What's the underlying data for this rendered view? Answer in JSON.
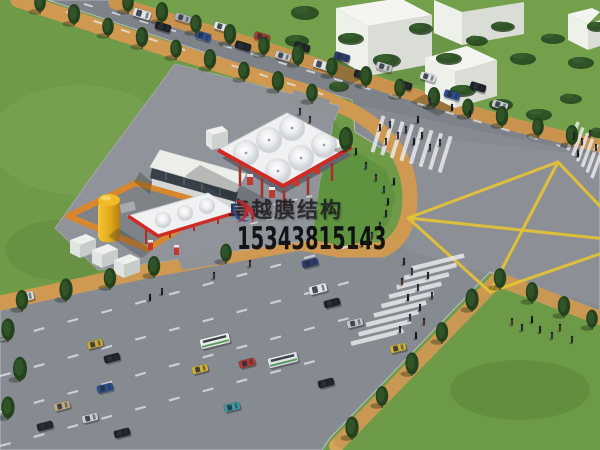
{
  "watermark": {
    "company": "卓越膜结构",
    "phone": "15343815143",
    "text_color": "#1c1c20",
    "logo_red": "#c1272d",
    "logo_blue": "#2050a0"
  },
  "scene": {
    "description": "Aerial 3D rendering of a membrane-structure gas station beside a signalized road intersection with yellow box-junction marking",
    "palette": {
      "grass": "#6f9b49",
      "grass_dark": "#5e8a3c",
      "verge_green": "#5f9340",
      "pavement": "#868b91",
      "station_lot": "#90949a",
      "sidewalk_tan": "#cf9952",
      "sidewalk_brick": "#c28a40",
      "canopy_white": "#f0f1f3",
      "canopy_red_trim": "#cf2b24",
      "marking_yellow": "#e3c236",
      "crosswalk_white": "#eaecef",
      "tank_yellow": "#eec02a",
      "yard_wall_orange": "#d8872e",
      "building_white": "#eef0ea",
      "tree_dark_green": "#24421d"
    },
    "box_marking": {
      "outline": [
        [
          408,
          218
        ],
        [
          558,
          162
        ],
        [
          634,
          242
        ],
        [
          490,
          292
        ]
      ],
      "diagonals": [
        [
          408,
          218,
          634,
          242
        ],
        [
          558,
          162,
          490,
          292
        ]
      ],
      "color": "#e3c236"
    },
    "crosswalks": [
      {
        "x": 378,
        "y": 134,
        "dx": 9.6,
        "dy": 2.9,
        "n": 8,
        "w": 4,
        "h": 38,
        "a": 17
      },
      {
        "x": 573,
        "y": 136,
        "dx": 4.8,
        "dy": 5.6,
        "n": 6,
        "w": 3.5,
        "h": 30,
        "a": 20
      },
      {
        "x": 438,
        "y": 262,
        "dx": -7.6,
        "dy": 9.4,
        "n": 9,
        "w": 54,
        "h": 4.5,
        "a": -14
      }
    ],
    "lane_lines": [
      {
        "x1": 84,
        "y1": 4,
        "x2": 560,
        "y2": 146,
        "w": 2,
        "dash": "9 20"
      },
      {
        "x1": 66,
        "y1": 12,
        "x2": 340,
        "y2": 100,
        "w": 2,
        "dash": "9 20"
      },
      {
        "x1": 0,
        "y1": 340,
        "x2": 368,
        "y2": 241,
        "w": 2.2,
        "dash": "11 24"
      },
      {
        "x1": 0,
        "y1": 376,
        "x2": 368,
        "y2": 277,
        "w": 2.2,
        "dash": "11 24"
      },
      {
        "x1": 0,
        "y1": 412,
        "x2": 368,
        "y2": 313,
        "w": 2.2,
        "dash": "11 24"
      },
      {
        "x1": 0,
        "y1": 446,
        "x2": 330,
        "y2": 357,
        "w": 2.2,
        "dash": "11 24"
      },
      {
        "x1": 240,
        "y1": 212,
        "x2": 312,
        "y2": 196,
        "w": 1.6,
        "dash": "8 9"
      },
      {
        "x1": 250,
        "y1": 224,
        "x2": 318,
        "y2": 208,
        "w": 1.6,
        "dash": "8 9"
      }
    ],
    "trees": [
      [
        128,
        8,
        9
      ],
      [
        162,
        18,
        10
      ],
      [
        196,
        29,
        9
      ],
      [
        230,
        40,
        10
      ],
      [
        264,
        51,
        9
      ],
      [
        298,
        61,
        10
      ],
      [
        332,
        72,
        9
      ],
      [
        366,
        82,
        10
      ],
      [
        400,
        93,
        9
      ],
      [
        434,
        103,
        10
      ],
      [
        468,
        113,
        9
      ],
      [
        502,
        122,
        10
      ],
      [
        538,
        132,
        9
      ],
      [
        572,
        141,
        10
      ],
      [
        40,
        8,
        9
      ],
      [
        74,
        20,
        10
      ],
      [
        108,
        32,
        9
      ],
      [
        142,
        43,
        10
      ],
      [
        176,
        54,
        9
      ],
      [
        210,
        65,
        10
      ],
      [
        244,
        76,
        9
      ],
      [
        278,
        87,
        10
      ],
      [
        312,
        98,
        9
      ],
      [
        346,
        146,
        12
      ],
      [
        22,
        306,
        10
      ],
      [
        66,
        296,
        11
      ],
      [
        110,
        284,
        10
      ],
      [
        154,
        272,
        10
      ],
      [
        226,
        258,
        9
      ],
      [
        352,
        434,
        11
      ],
      [
        382,
        402,
        10
      ],
      [
        412,
        370,
        11
      ],
      [
        442,
        338,
        10
      ],
      [
        472,
        306,
        11
      ],
      [
        500,
        284,
        10
      ],
      [
        532,
        298,
        10
      ],
      [
        564,
        312,
        10
      ],
      [
        592,
        324,
        9
      ],
      [
        8,
        336,
        11
      ],
      [
        20,
        376,
        12
      ],
      [
        8,
        414,
        11
      ]
    ],
    "bushes": [
      [
        304,
        12,
        14,
        7
      ],
      [
        296,
        40,
        12,
        6
      ],
      [
        350,
        38,
        13,
        6
      ],
      [
        386,
        60,
        14,
        7
      ],
      [
        420,
        28,
        12,
        6
      ],
      [
        448,
        58,
        13,
        6
      ],
      [
        476,
        40,
        11,
        5
      ],
      [
        502,
        26,
        12,
        5
      ],
      [
        522,
        58,
        13,
        6
      ],
      [
        552,
        38,
        12,
        5
      ],
      [
        580,
        62,
        13,
        6
      ],
      [
        596,
        26,
        10,
        5
      ],
      [
        462,
        90,
        13,
        6
      ],
      [
        500,
        104,
        12,
        6
      ],
      [
        538,
        114,
        13,
        6
      ],
      [
        570,
        98,
        11,
        5
      ],
      [
        338,
        86,
        10,
        5
      ],
      [
        598,
        132,
        9,
        5
      ]
    ],
    "vehicles": [
      [
        142,
        14,
        17,
        "#dfe2e6",
        "v"
      ],
      [
        163,
        27,
        17,
        "#1e2126",
        "c"
      ],
      [
        183,
        18,
        17,
        "#aeb2b8",
        "c"
      ],
      [
        203,
        36,
        17,
        "#2b4f92",
        "c"
      ],
      [
        222,
        27,
        17,
        "#dfe2e6",
        "c"
      ],
      [
        243,
        46,
        17,
        "#1e2126",
        "c"
      ],
      [
        262,
        37,
        17,
        "#a93a31",
        "c"
      ],
      [
        283,
        56,
        17,
        "#c6c9ce",
        "c"
      ],
      [
        302,
        47,
        17,
        "#1e2126",
        "c"
      ],
      [
        322,
        65,
        17,
        "#dfe2e6",
        "v"
      ],
      [
        342,
        57,
        17,
        "#2c3e71",
        "c"
      ],
      [
        362,
        75,
        17,
        "#1e2126",
        "c"
      ],
      [
        384,
        67,
        17,
        "#c6c9ce",
        "c"
      ],
      [
        404,
        85,
        17,
        "#1e2126",
        "c"
      ],
      [
        428,
        77,
        17,
        "#dfe2e6",
        "c"
      ],
      [
        452,
        95,
        17,
        "#2b4f92",
        "c"
      ],
      [
        478,
        87,
        17,
        "#1e2126",
        "c"
      ],
      [
        500,
        105,
        17,
        "#c6c9ce",
        "c"
      ],
      [
        25,
        297,
        -14,
        "#d9dcdf",
        "v"
      ],
      [
        95,
        344,
        -14,
        "#c9a93d",
        "c"
      ],
      [
        112,
        358,
        -14,
        "#1e2126",
        "c"
      ],
      [
        200,
        369,
        -14,
        "#d2b13c",
        "c"
      ],
      [
        247,
        363,
        -14,
        "#b03a31",
        "c"
      ],
      [
        232,
        407,
        -14,
        "#3d9aa0",
        "c"
      ],
      [
        105,
        388,
        -14,
        "#2b4f92",
        "c"
      ],
      [
        90,
        418,
        -14,
        "#caccd1",
        "c"
      ],
      [
        122,
        433,
        -14,
        "#1e2126",
        "c"
      ],
      [
        45,
        426,
        -14,
        "#22252a",
        "c"
      ],
      [
        62,
        406,
        -14,
        "#c2aa80",
        "c"
      ],
      [
        215,
        341,
        -14,
        "#eceeef",
        "b"
      ],
      [
        283,
        360,
        -14,
        "#e0e3e6",
        "b"
      ],
      [
        318,
        289,
        -14,
        "#e2e5e8",
        "v"
      ],
      [
        310,
        263,
        -14,
        "#2c3e71",
        "c"
      ],
      [
        332,
        303,
        -14,
        "#1e2126",
        "c"
      ],
      [
        355,
        323,
        -14,
        "#c3c7cc",
        "c"
      ],
      [
        398,
        348,
        -14,
        "#ccb23a",
        "c"
      ],
      [
        326,
        383,
        -14,
        "#1e2126",
        "c"
      ]
    ],
    "pedestrians": [
      [
        380,
        128
      ],
      [
        390,
        125
      ],
      [
        398,
        136
      ],
      [
        406,
        130
      ],
      [
        414,
        142
      ],
      [
        422,
        136
      ],
      [
        430,
        148
      ],
      [
        386,
        142
      ],
      [
        440,
        143
      ],
      [
        418,
        120
      ],
      [
        574,
        136
      ],
      [
        582,
        142
      ],
      [
        590,
        134
      ],
      [
        596,
        148
      ],
      [
        578,
        154
      ],
      [
        356,
        152
      ],
      [
        366,
        166
      ],
      [
        376,
        178
      ],
      [
        384,
        190
      ],
      [
        388,
        202
      ],
      [
        386,
        214
      ],
      [
        380,
        226
      ],
      [
        372,
        236
      ],
      [
        362,
        244
      ],
      [
        394,
        182
      ],
      [
        404,
        262
      ],
      [
        412,
        272
      ],
      [
        402,
        282
      ],
      [
        418,
        288
      ],
      [
        408,
        298
      ],
      [
        420,
        308
      ],
      [
        410,
        318
      ],
      [
        424,
        322
      ],
      [
        400,
        330
      ],
      [
        416,
        336
      ],
      [
        428,
        276
      ],
      [
        432,
        296
      ],
      [
        512,
        322
      ],
      [
        522,
        328
      ],
      [
        532,
        320
      ],
      [
        540,
        330
      ],
      [
        552,
        336
      ],
      [
        560,
        328
      ],
      [
        572,
        340
      ],
      [
        150,
        298
      ],
      [
        162,
        292
      ],
      [
        214,
        276
      ],
      [
        250,
        264
      ],
      [
        430,
        102
      ],
      [
        452,
        108
      ],
      [
        470,
        114
      ],
      [
        300,
        112
      ],
      [
        310,
        120
      ]
    ]
  }
}
